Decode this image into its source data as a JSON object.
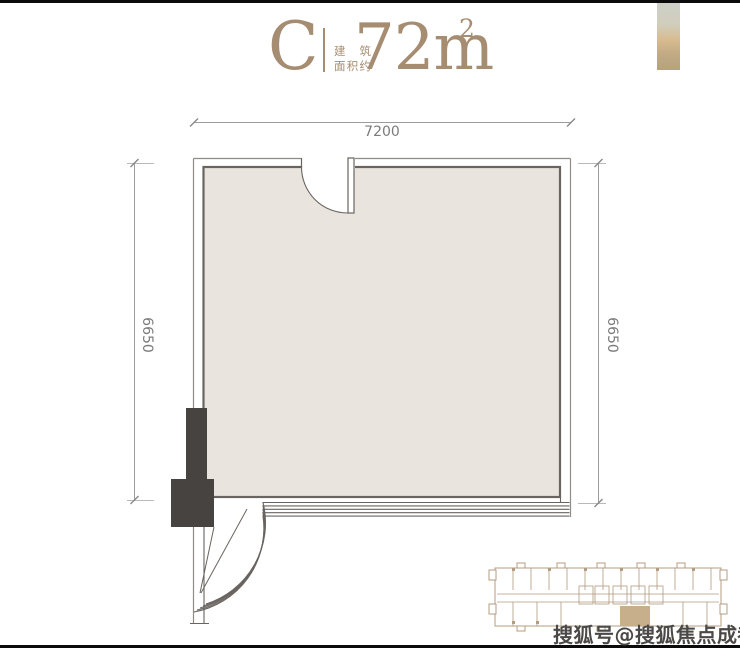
{
  "header": {
    "unit_label": "C",
    "caption_line1": "建 筑",
    "caption_line2": "面积约",
    "area_value": "72m",
    "area_sup": "2"
  },
  "floor_plan": {
    "dimensions": {
      "top": "7200",
      "left": "6650",
      "right": "6650"
    },
    "features": [
      "entry-door-top",
      "corner-curved-window-bottom-left",
      "structural-column-bottom-left",
      "window-band-bottom"
    ]
  },
  "key_plan": {
    "description": "building-floor-plate-mini-map",
    "highlighted_unit_color": "#c8af8b"
  },
  "watermark": {
    "text": "搜狐号@搜狐焦点成都站"
  },
  "colors": {
    "accent_tan": "#a68d72",
    "floor_fill": "#e9e4de",
    "wall_line": "#696460",
    "outer_line": "#8f8b87",
    "dimension_line": "#9c9c9c",
    "dimension_text": "#7b7b7b",
    "column_fill": "#474341",
    "key_plan_line": "#b39c7f",
    "watermark_text": "#4b4947",
    "edge_bar": "#0b0b0b"
  }
}
